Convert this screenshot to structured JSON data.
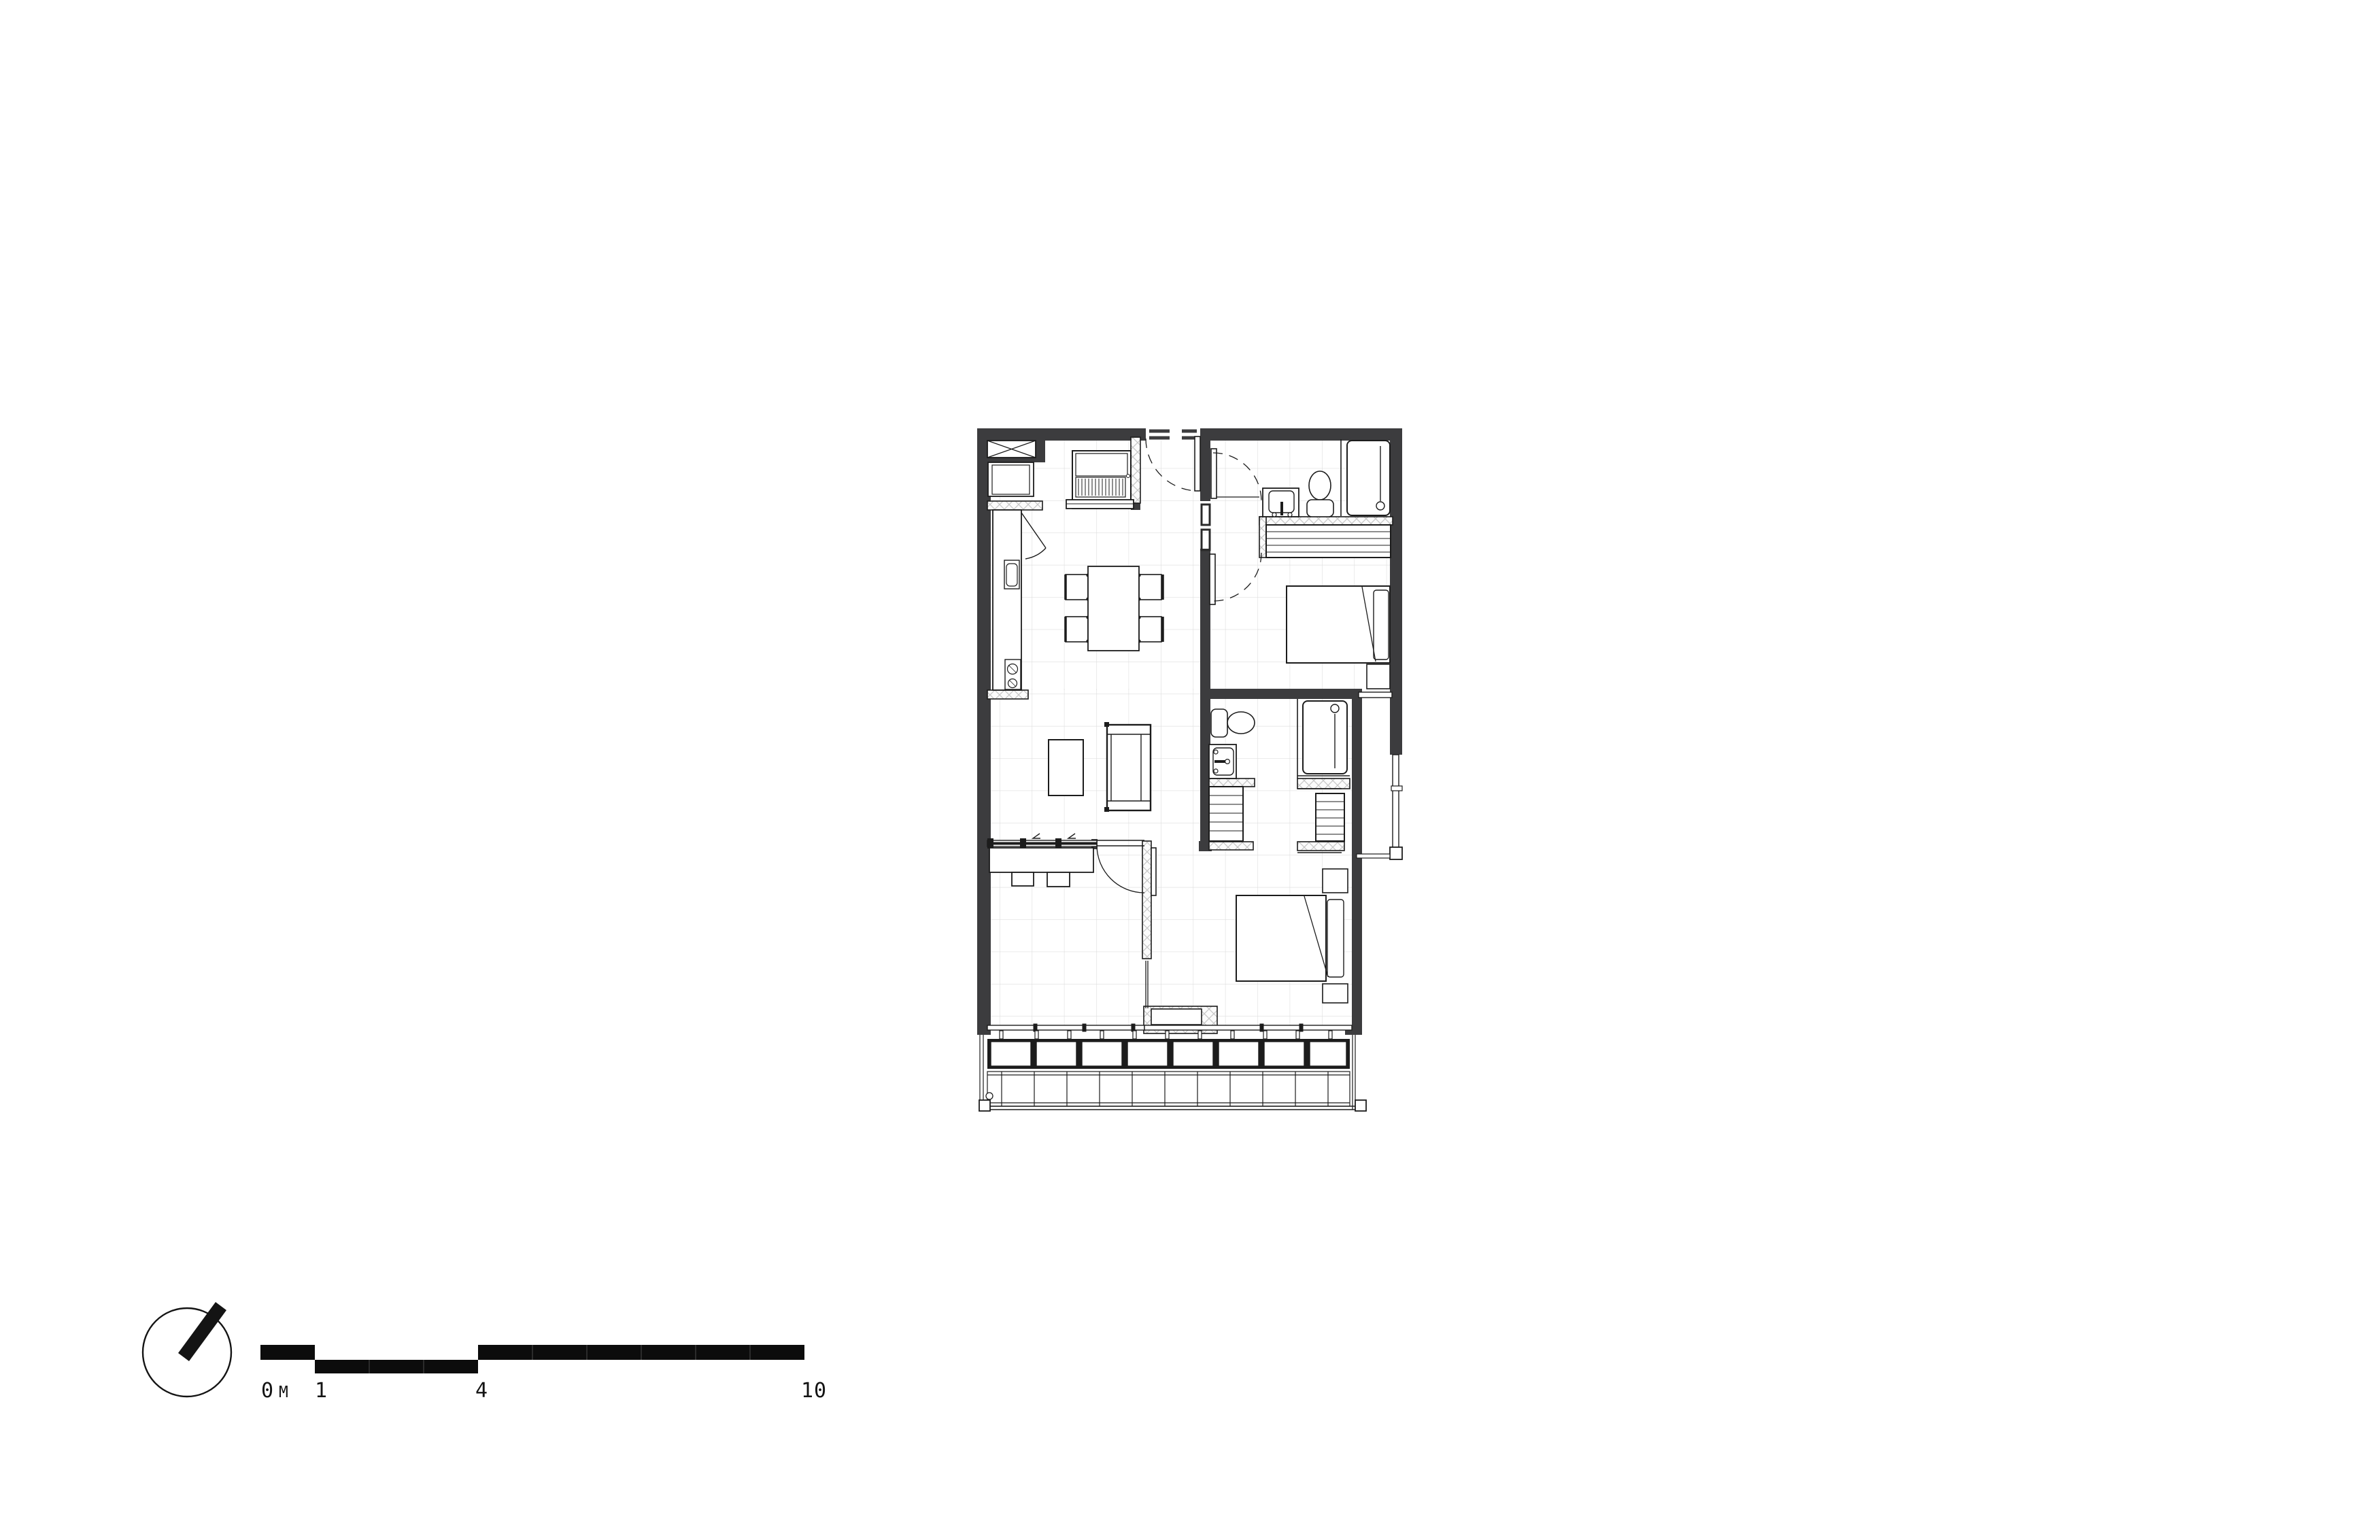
{
  "drawing": {
    "kind": "apartment floor plan",
    "colors": {
      "background": "#ffffff",
      "wall": "#3c3c3e",
      "line": "#1c1c1c",
      "grid": "#dddddd",
      "hatch": "#c6c6c6",
      "fixture_fill": "#ffffff"
    },
    "rooms": [
      "kitchen-dining",
      "living-room",
      "entry-hall",
      "bathroom-1",
      "bedroom-1",
      "ensuite-bathroom-2",
      "bedroom-2-study",
      "balcony"
    ],
    "fixtures": [
      "dining-table",
      "dining-chairs",
      "kitchen-counter",
      "sink",
      "cooktop",
      "fridge",
      "linen-cupboard",
      "appliance-niche",
      "coffee-table",
      "sofa",
      "desk-with-stools",
      "toilet-1",
      "vanity-1",
      "shower-1",
      "robe-1",
      "bed-1",
      "bedside-table-1",
      "toilet-2",
      "vanity-2",
      "shower-2",
      "walkthrough-robes",
      "bed-2",
      "bedside-tables-2",
      "planter-boxes",
      "balcony-decking",
      "north-arrow"
    ]
  },
  "scale_bar": {
    "unit": "M",
    "pixels_per_meter": 80,
    "labels": {
      "zero": "0",
      "unit": "M",
      "one": "1",
      "four": "4",
      "ten": "10"
    }
  }
}
